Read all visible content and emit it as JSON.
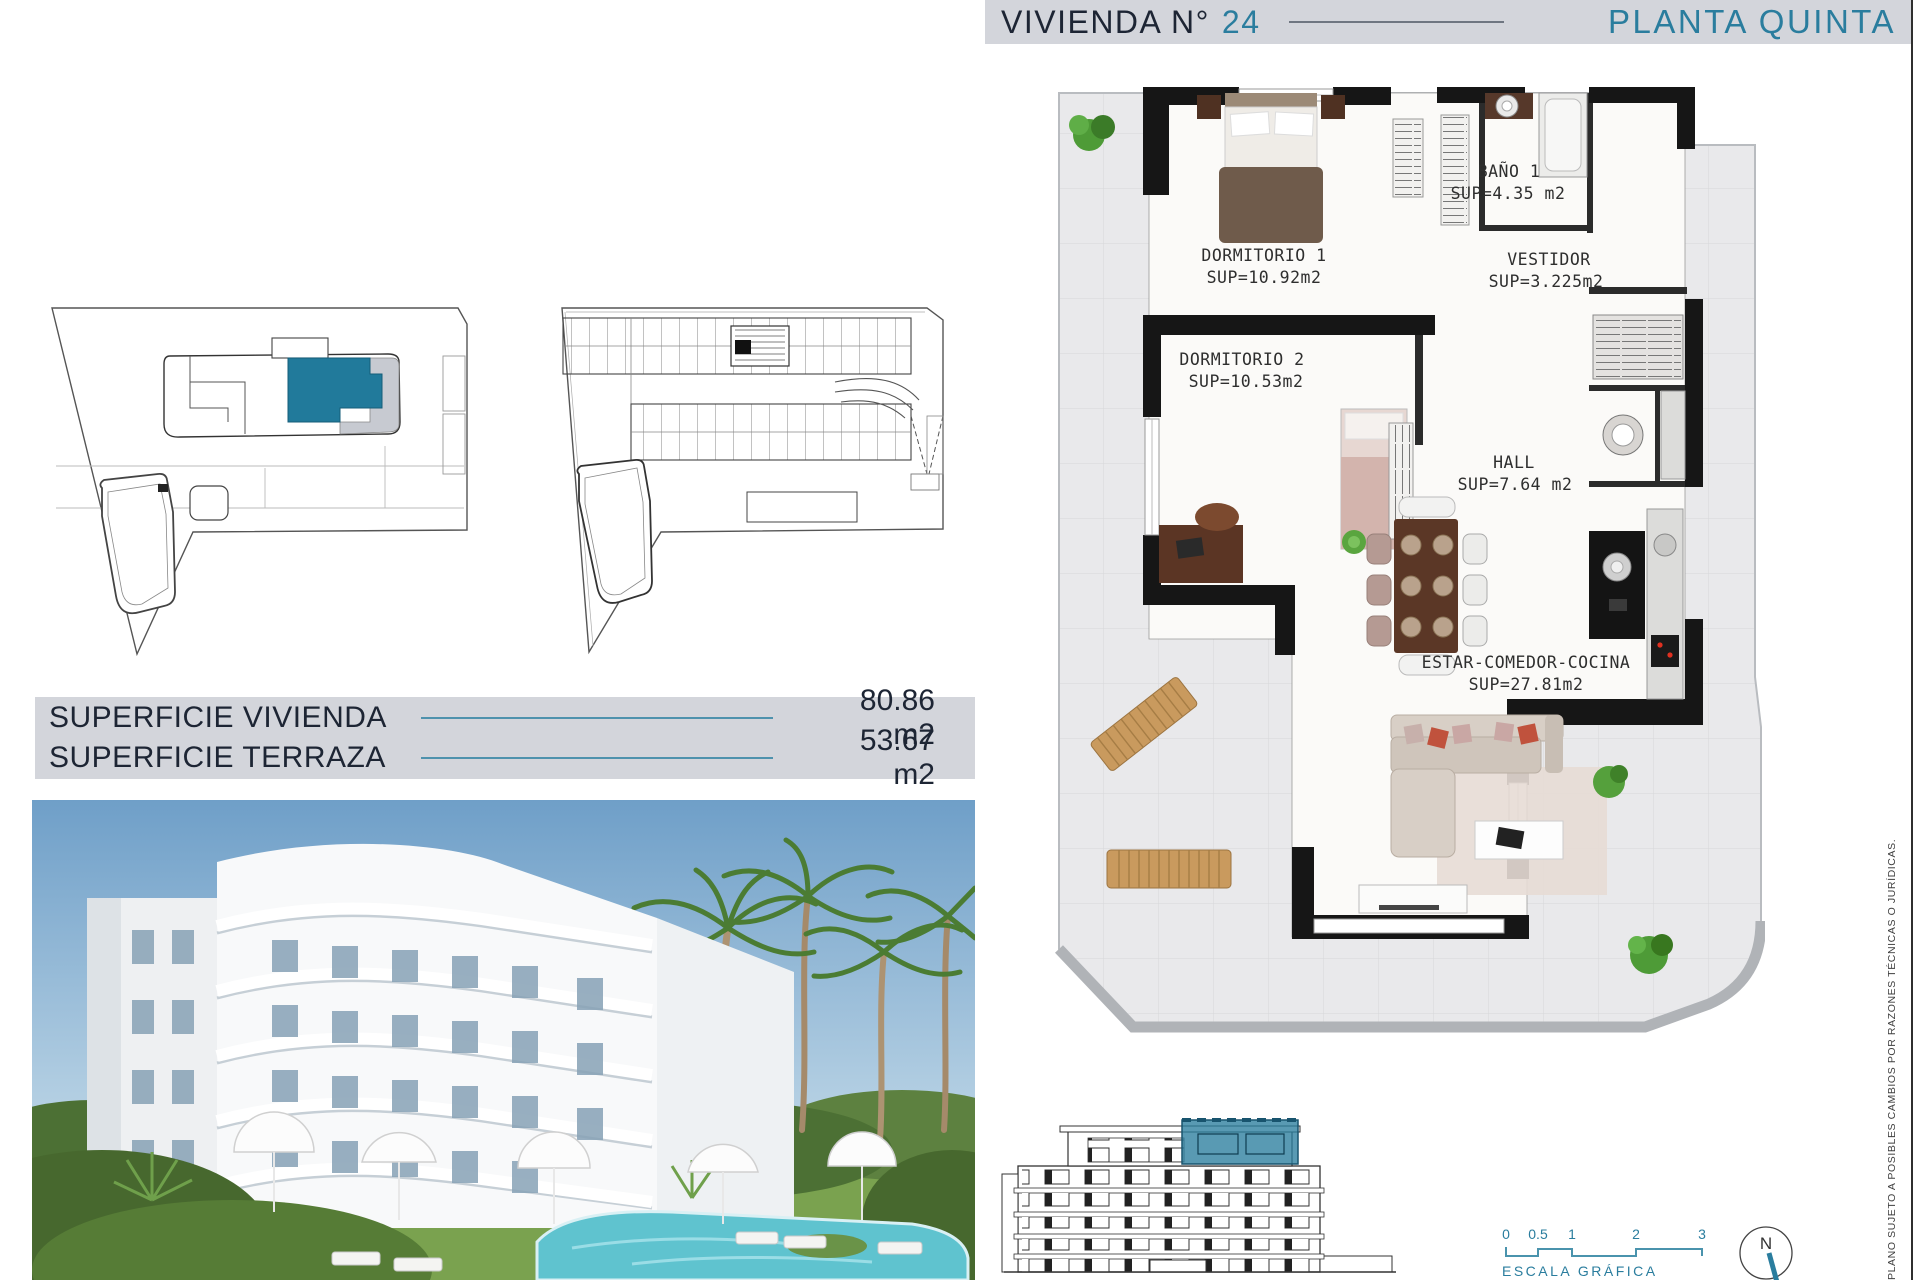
{
  "header": {
    "title": "VIVIENDA N°",
    "number": "24",
    "floor": "PLANTA QUINTA"
  },
  "floor_plan": {
    "rooms": [
      {
        "name": "DORMITORIO 1",
        "sup": "SUP=10.92m2"
      },
      {
        "name": "BAÑO 1",
        "sup": "SUP=4.35 m2"
      },
      {
        "name": "VESTIDOR",
        "sup": "SUP=3.225m2"
      },
      {
        "name": "DORMITORIO 2",
        "sup": "SUP=10.53m2"
      },
      {
        "name": "HALL",
        "sup": "SUP=7.64 m2"
      },
      {
        "name": "ESTAR-COMEDOR-COCINA",
        "sup": "SUP=27.81m2"
      }
    ]
  },
  "surfaces": {
    "rows": [
      {
        "label": "SUPERFICIE VIVIENDA",
        "value": "80.86 m2"
      },
      {
        "label": "SUPERFICIE TERRAZA",
        "value": "53.67 m2"
      }
    ]
  },
  "scale": {
    "ticks": [
      "0",
      "0.5",
      "1",
      "2",
      "3"
    ],
    "label": "ESCALA GRÁFICA"
  },
  "compass": {
    "north": "N"
  },
  "disclaimer": "PLANO SUJETO A POSIBLES CAMBIOS POR RAZONES TÉCNICAS O JURÍDICAS.",
  "colors": {
    "accent_teal": "#2a7d9e",
    "header_bg": "#d3d5db",
    "text_dark": "#1d2534",
    "wall_black": "#161616",
    "tile_gray": "#e9e9eb",
    "pool_blue": "#5fc3cf"
  }
}
